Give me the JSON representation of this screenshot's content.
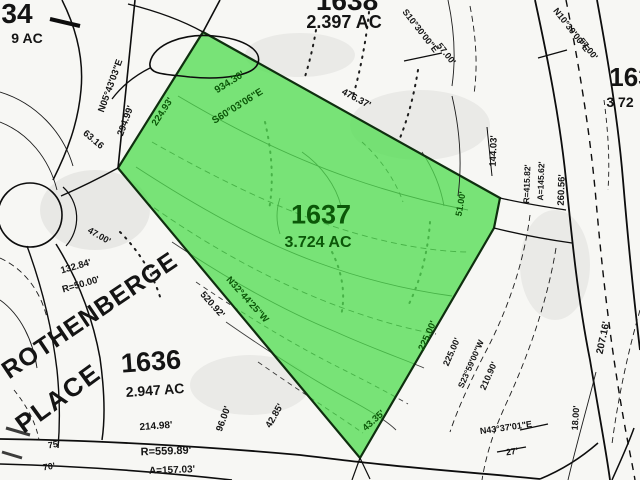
{
  "colors": {
    "ink": "#141414",
    "green": "#0b5708",
    "parcel_fill": "#4BDC4B"
  },
  "labels": [
    {
      "name": "parcel-1634-number",
      "text": "34",
      "x": 17,
      "y": 14,
      "r": 0,
      "s": 28,
      "tone": "ink"
    },
    {
      "name": "parcel-1634-acreage",
      "text": "9 AC",
      "x": 27,
      "y": 38,
      "r": 0,
      "s": 14,
      "tone": "ink"
    },
    {
      "name": "parcel-1638-number",
      "text": "1638",
      "x": 347,
      "y": 1,
      "r": 0,
      "s": 28,
      "tone": "ink"
    },
    {
      "name": "parcel-1638-acreage",
      "text": "2.397 AC",
      "x": 344,
      "y": 22,
      "r": 0,
      "s": 18,
      "tone": "ink"
    },
    {
      "name": "parcel-right-number",
      "text": "163",
      "x": 631,
      "y": 77,
      "r": 0,
      "s": 26,
      "tone": "ink"
    },
    {
      "name": "parcel-right-acreage",
      "text": "3 72",
      "x": 620,
      "y": 102,
      "r": 0,
      "s": 14,
      "tone": "ink"
    },
    {
      "name": "bearing-label",
      "text": "N05°43'03\"E",
      "x": 111,
      "y": 86,
      "r": -70,
      "s": 9.5,
      "tone": "ink"
    },
    {
      "name": "distance-label",
      "text": "294.99'",
      "x": 126,
      "y": 121,
      "r": -70,
      "s": 9.5,
      "tone": "ink"
    },
    {
      "name": "distance-label",
      "text": "63.16",
      "x": 93,
      "y": 140,
      "r": 40,
      "s": 9.5,
      "tone": "ink"
    },
    {
      "name": "distance-label",
      "text": "224.93'",
      "x": 163,
      "y": 112,
      "r": -57,
      "s": 9.5,
      "tone": "green"
    },
    {
      "name": "distance-label",
      "text": "934.30'",
      "x": 230,
      "y": 83,
      "r": -32,
      "s": 10,
      "tone": "green"
    },
    {
      "name": "bearing-label",
      "text": "S60°03'06\"E",
      "x": 238,
      "y": 107,
      "r": -32,
      "s": 10,
      "tone": "green"
    },
    {
      "name": "distance-label",
      "text": "476.37'",
      "x": 356,
      "y": 99,
      "r": 28,
      "s": 9.5,
      "tone": "ink"
    },
    {
      "name": "bearing-label",
      "text": "S10°30'00\"E",
      "x": 420,
      "y": 31,
      "r": 52,
      "s": 9,
      "tone": "ink"
    },
    {
      "name": "distance-label",
      "text": "57.00'",
      "x": 446,
      "y": 54,
      "r": 52,
      "s": 9,
      "tone": "ink"
    },
    {
      "name": "bearing-label",
      "text": "N10°30'00\"E",
      "x": 571,
      "y": 30,
      "r": 52,
      "s": 9,
      "tone": "ink"
    },
    {
      "name": "distance-label",
      "text": "57.00'",
      "x": 588,
      "y": 49,
      "r": 52,
      "s": 9,
      "tone": "ink"
    },
    {
      "name": "distance-label",
      "text": "144.03'",
      "x": 494,
      "y": 151,
      "r": -88,
      "s": 9.5,
      "tone": "ink"
    },
    {
      "name": "curve-label",
      "text": "R=415.82'",
      "x": 527,
      "y": 184,
      "r": -88,
      "s": 8.5,
      "tone": "ink"
    },
    {
      "name": "curve-label",
      "text": "A=145.62'",
      "x": 541,
      "y": 181,
      "r": -88,
      "s": 8.5,
      "tone": "ink"
    },
    {
      "name": "distance-label",
      "text": "260.56'",
      "x": 562,
      "y": 190,
      "r": -88,
      "s": 9.5,
      "tone": "ink"
    },
    {
      "name": "distance-label",
      "text": "51.00'",
      "x": 461,
      "y": 204,
      "r": -80,
      "s": 9,
      "tone": "green"
    },
    {
      "name": "parcel-1637-number",
      "text": "1637",
      "x": 321,
      "y": 215,
      "r": 0,
      "s": 27,
      "tone": "green"
    },
    {
      "name": "parcel-1637-acreage",
      "text": "3.724 AC",
      "x": 318,
      "y": 243,
      "r": 0,
      "s": 16,
      "tone": "green"
    },
    {
      "name": "bearing-label",
      "text": "N32°44'25\"W",
      "x": 247,
      "y": 300,
      "r": 48,
      "s": 9.5,
      "tone": "green"
    },
    {
      "name": "distance-label",
      "text": "520.92'",
      "x": 212,
      "y": 305,
      "r": 48,
      "s": 9.5,
      "tone": "ink"
    },
    {
      "name": "distance-label",
      "text": "47.00'",
      "x": 99,
      "y": 236,
      "r": 30,
      "s": 9,
      "tone": "ink"
    },
    {
      "name": "distance-label",
      "text": "132.84'",
      "x": 76,
      "y": 267,
      "r": -16,
      "s": 9.5,
      "tone": "ink"
    },
    {
      "name": "curve-label",
      "text": "R=50.00'",
      "x": 81,
      "y": 285,
      "r": -16,
      "s": 9.5,
      "tone": "ink"
    },
    {
      "name": "street-name",
      "text": "ROTHENBERGE",
      "x": 90,
      "y": 316,
      "r": -34,
      "s": 25,
      "tone": "ink",
      "ls": 1
    },
    {
      "name": "street-name",
      "text": "PLACE",
      "x": 58,
      "y": 398,
      "r": -36,
      "s": 26,
      "tone": "ink",
      "ls": 2
    },
    {
      "name": "parcel-1636-number",
      "text": "1636",
      "x": 151,
      "y": 362,
      "r": -4,
      "s": 27,
      "tone": "ink"
    },
    {
      "name": "parcel-1636-acreage",
      "text": "2.947 AC",
      "x": 155,
      "y": 390,
      "r": -4,
      "s": 14,
      "tone": "ink"
    },
    {
      "name": "distance-label",
      "text": "75'",
      "x": 54,
      "y": 445,
      "r": -8,
      "s": 9,
      "tone": "ink"
    },
    {
      "name": "distance-label",
      "text": "70'",
      "x": 49,
      "y": 467,
      "r": -8,
      "s": 9,
      "tone": "ink"
    },
    {
      "name": "distance-label",
      "text": "214.98'",
      "x": 156,
      "y": 427,
      "r": -4,
      "s": 10,
      "tone": "ink"
    },
    {
      "name": "curve-label",
      "text": "R=559.89'",
      "x": 166,
      "y": 452,
      "r": -2,
      "s": 11,
      "tone": "ink"
    },
    {
      "name": "curve-label",
      "text": "A=157.03'",
      "x": 172,
      "y": 471,
      "r": -2,
      "s": 10,
      "tone": "ink"
    },
    {
      "name": "distance-label",
      "text": "96.00'",
      "x": 224,
      "y": 419,
      "r": -70,
      "s": 9.5,
      "tone": "ink"
    },
    {
      "name": "distance-label",
      "text": "42.85'",
      "x": 275,
      "y": 416,
      "r": -60,
      "s": 9.5,
      "tone": "ink"
    },
    {
      "name": "distance-label",
      "text": "43.35'",
      "x": 374,
      "y": 421,
      "r": -42,
      "s": 9.5,
      "tone": "green"
    },
    {
      "name": "distance-label",
      "text": "225.00'",
      "x": 428,
      "y": 336,
      "r": -66,
      "s": 9.5,
      "tone": "green"
    },
    {
      "name": "distance-label",
      "text": "225.00'",
      "x": 452,
      "y": 352,
      "r": -66,
      "s": 9,
      "tone": "ink"
    },
    {
      "name": "bearing-label",
      "text": "S23°59'00\"W",
      "x": 471,
      "y": 364,
      "r": -66,
      "s": 8.5,
      "tone": "ink"
    },
    {
      "name": "distance-label",
      "text": "210.90'",
      "x": 489,
      "y": 376,
      "r": -66,
      "s": 9,
      "tone": "ink"
    },
    {
      "name": "bearing-label",
      "text": "N43°37'01\"E",
      "x": 506,
      "y": 428,
      "r": -8,
      "s": 9,
      "tone": "ink"
    },
    {
      "name": "distance-label",
      "text": "27'",
      "x": 512,
      "y": 452,
      "r": -8,
      "s": 9,
      "tone": "ink"
    },
    {
      "name": "distance-label",
      "text": "207.16'",
      "x": 604,
      "y": 338,
      "r": -78,
      "s": 10,
      "tone": "ink"
    },
    {
      "name": "distance-label",
      "text": "18.00'",
      "x": 576,
      "y": 418,
      "r": -86,
      "s": 9,
      "tone": "ink"
    }
  ]
}
